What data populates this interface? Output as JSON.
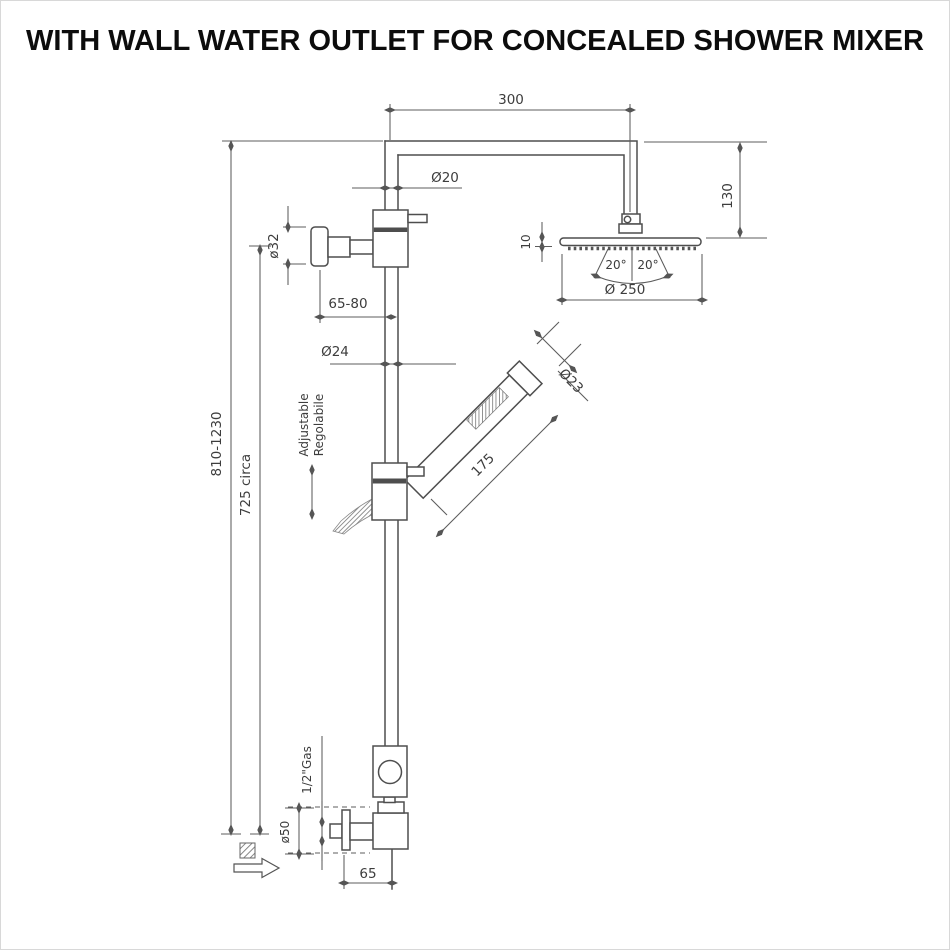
{
  "title": "WITH WALL WATER OUTLET FOR CONCEALED SHOWER MIXER",
  "dimensions": {
    "arm_length": "300",
    "arm_pipe_diameter": "Ø20",
    "head_drop_height": "130",
    "head_plate_thickness": "10",
    "spray_angle_left": "20°",
    "spray_angle_right": "20°",
    "head_diameter": "Ø 250",
    "wall_outlet_diameter": "ø32",
    "wall_clearance": "65-80",
    "riser_pipe_diameter": "Ø24",
    "column_height": "810-1230",
    "outlet_height": "725 circa",
    "handshower_length": "175",
    "handshower_diameter": "Ø23",
    "inlet_thread": "1/2\"Gas",
    "escutcheon_diameter": "ø50",
    "base_wall_offset": "65"
  },
  "notes": {
    "adjustable_en": "Adjustable",
    "adjustable_it": "Regolabile"
  }
}
